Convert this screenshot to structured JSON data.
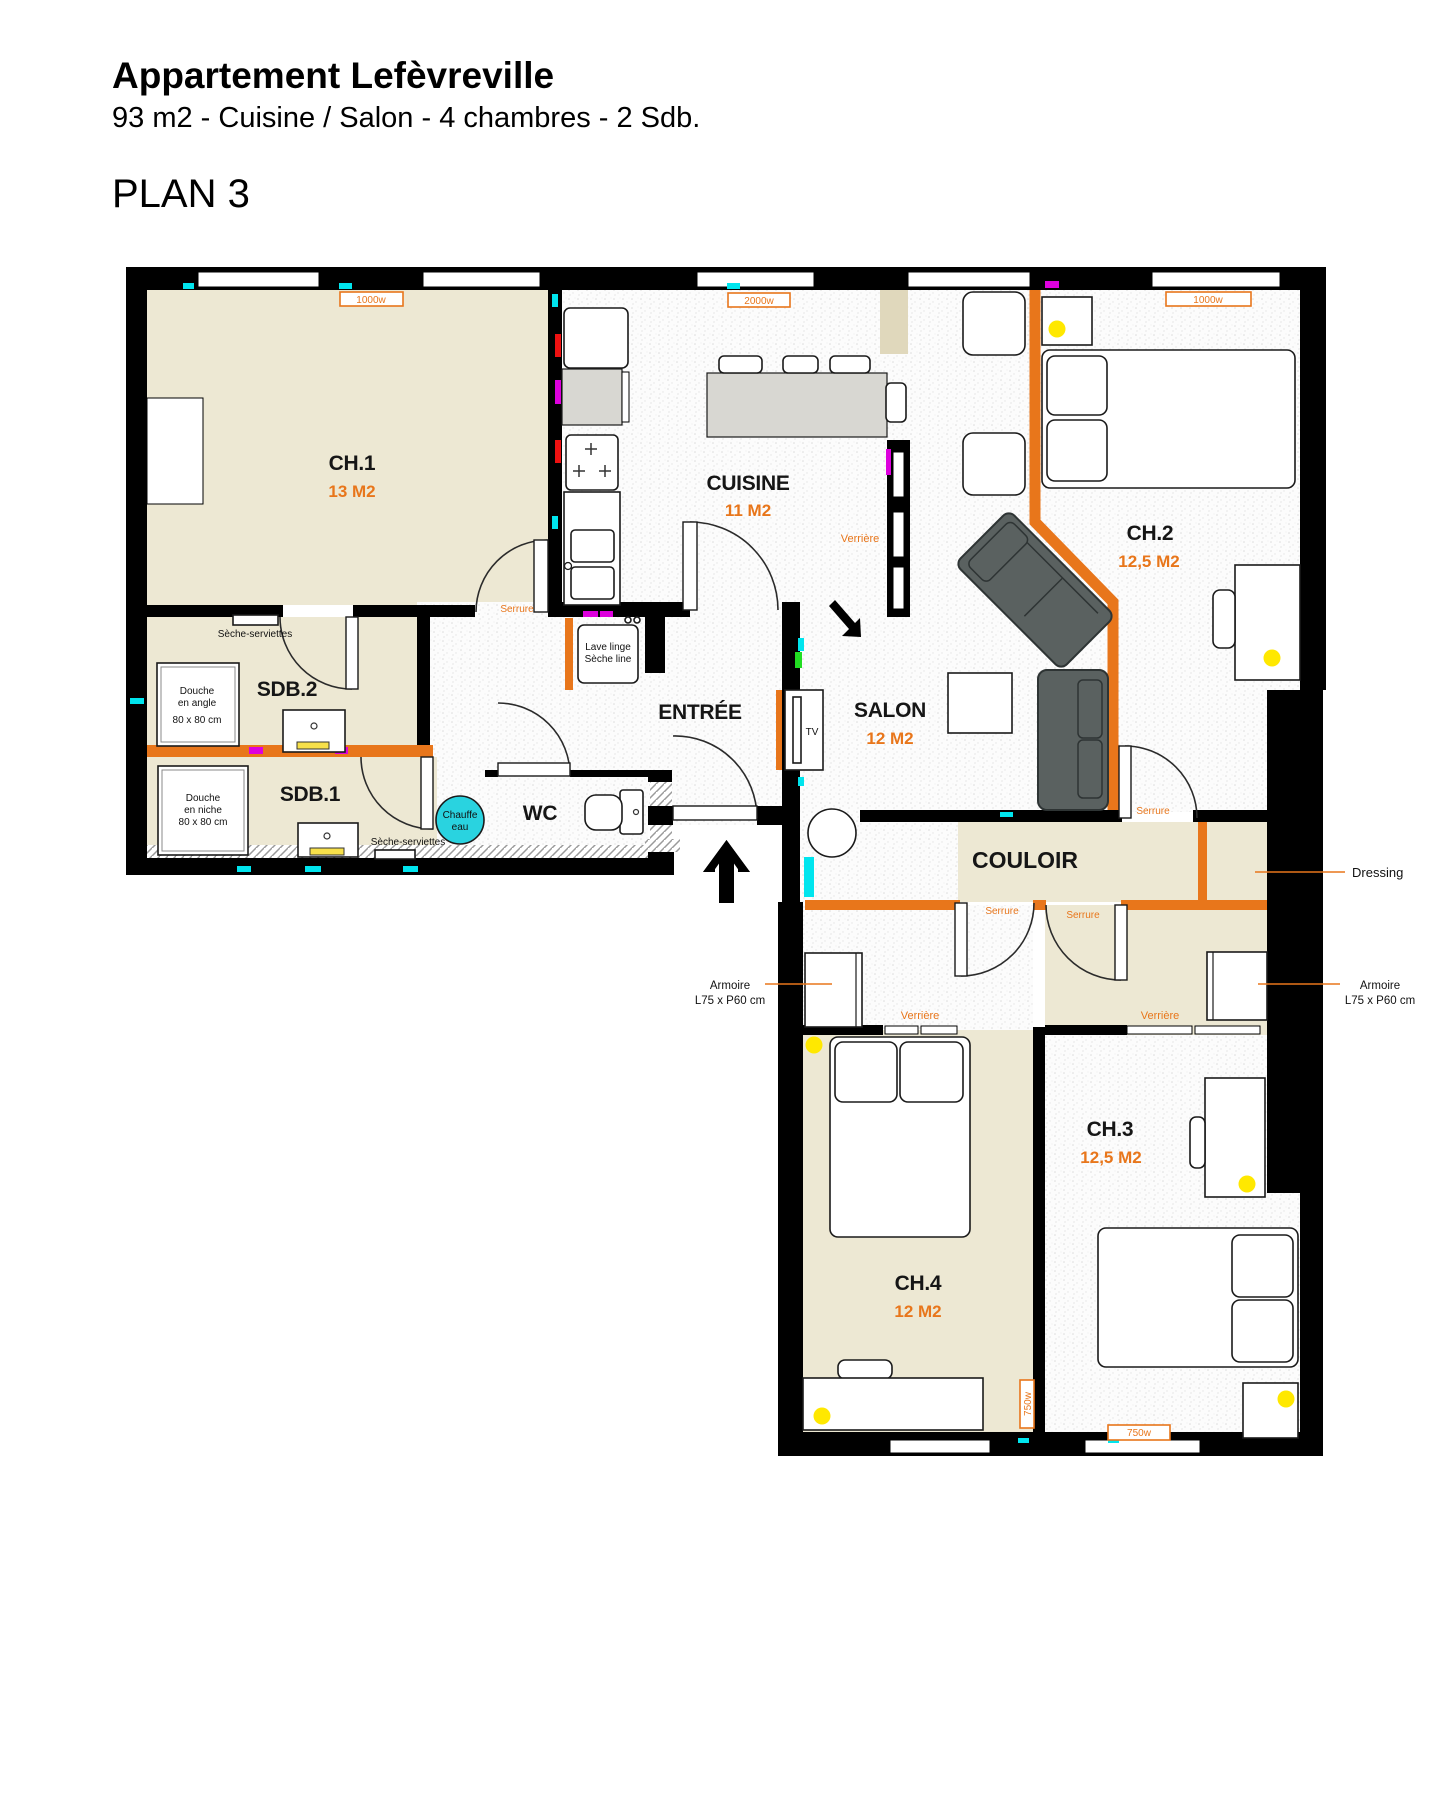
{
  "header": {
    "title": "Appartement Lefèvreville",
    "subtitle": "93 m2 - Cuisine / Salon - 4 chambres - 2 Sdb.",
    "plan": "PLAN 3"
  },
  "rooms": {
    "ch1": {
      "name": "CH.1",
      "area": "13 M2"
    },
    "cuisine": {
      "name": "CUISINE",
      "area": "11 M2"
    },
    "ch2": {
      "name": "CH.2",
      "area": "12,5 M2"
    },
    "salon": {
      "name": "SALON",
      "area": "12 M2"
    },
    "entree": {
      "name": "ENTRÉE"
    },
    "sdb2": {
      "name": "SDB.2"
    },
    "sdb1": {
      "name": "SDB.1"
    },
    "wc": {
      "name": "WC"
    },
    "couloir": {
      "name": "COULOIR"
    },
    "ch4": {
      "name": "CH.4",
      "area": "12 M2"
    },
    "ch3": {
      "name": "CH.3",
      "area": "12,5 M2"
    }
  },
  "annotations": {
    "serrure": "Serrure",
    "verriere": "Verrière",
    "dressing": "Dressing",
    "armoire_l1": "Armoire",
    "armoire_l2": "L75 x P60 cm",
    "seche_serviettes": "Sèche-serviettes",
    "douche_angle_l1": "Douche",
    "douche_angle_l2": "en angle",
    "douche_angle_l3": "80 x 80 cm",
    "douche_niche_l1": "Douche",
    "douche_niche_l2": "en niche",
    "douche_niche_l3": "80 x 80 cm",
    "chauffe_l1": "Chauffe",
    "chauffe_l2": "eau",
    "lave_l1": "Lave linge",
    "lave_l2": "Sèche line",
    "tv": "TV"
  },
  "radiators": {
    "r1": "1000w",
    "r2": "2000w",
    "r3": "1000w",
    "r4": "750w",
    "r5": "750w"
  },
  "colors": {
    "partition_orange": "#E8761B",
    "floor_beige": "#EDE8D3",
    "floor_duct_tan": "#E0D8BC",
    "wall_black": "#000000",
    "lamp_yellow": "#FFE800",
    "water_heater_cyan": "#29D3E0",
    "mark_cyan": "#00E5EE",
    "mark_red": "#EE1111",
    "mark_magenta": "#DD00DD",
    "mark_green": "#22DD22"
  }
}
